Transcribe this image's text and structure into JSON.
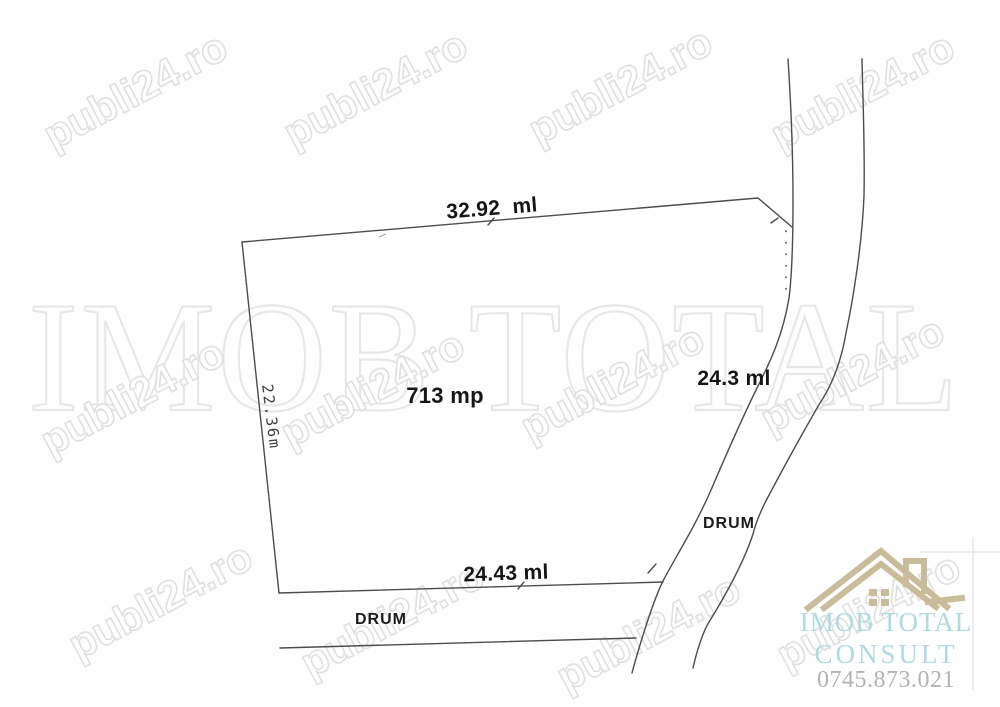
{
  "watermark": {
    "text": "publi24.ro",
    "big_text": "IMOB TOTAL",
    "stroke_color": "#e0e0e0",
    "big_stroke_color": "#e7e7e7"
  },
  "sketch": {
    "area_label": "713 mp",
    "top_dim": "32.92  ml",
    "left_dim": "22.36m",
    "right_dim": "24.3 ml",
    "bottom_dim": "24.43 ml",
    "right_road_label": "DRUM",
    "bottom_road_label": "DRUM",
    "line_color": "#4d4d4d"
  },
  "logo": {
    "name_line1": "IMOB TOTAL",
    "name_line2": "CONSULT",
    "phone": "0745.873.021",
    "text_color": "#aedbe0",
    "phone_color": "#b3b3b3",
    "house_color": "#c9bc9b"
  }
}
